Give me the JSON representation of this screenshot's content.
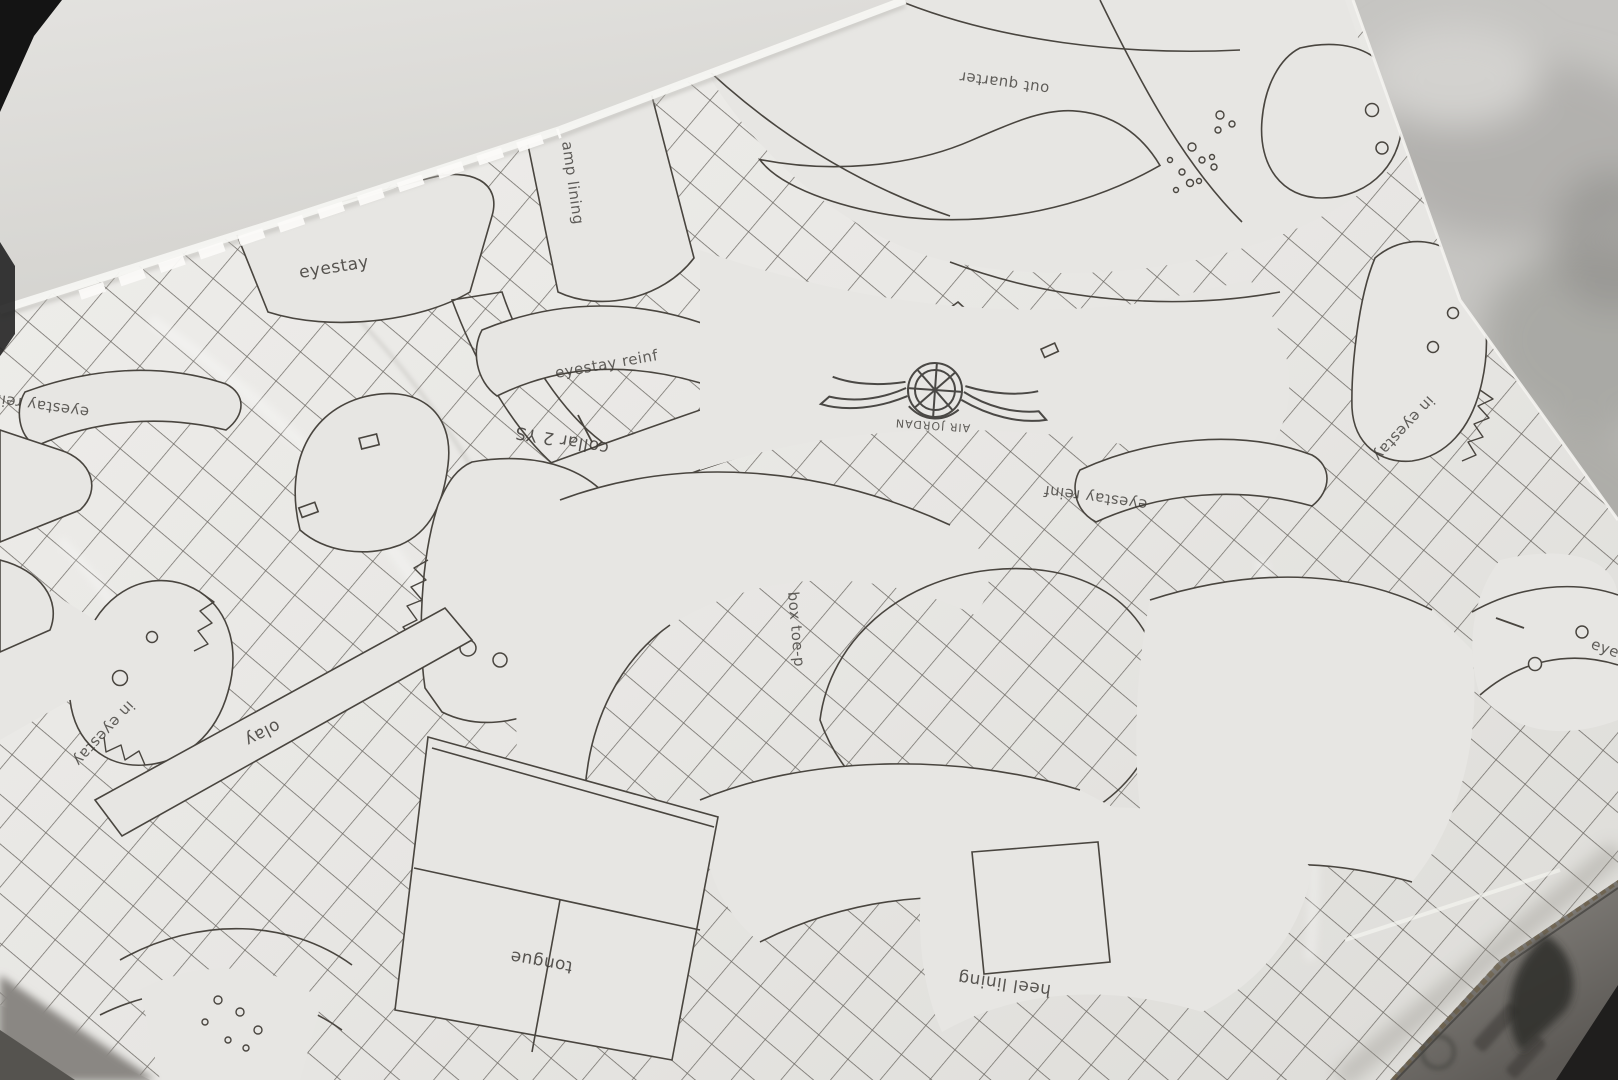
{
  "palette": {
    "paper": "#e7e6e3",
    "pattern_line": "#49453f",
    "hatch_line": "#56524c",
    "lid_interior": "#deddd9",
    "background_blur": "#c6c5c2",
    "shoebox_edge_gray": "#7d7a75",
    "corner_shadow_black": "#141414"
  },
  "paper_pattern": {
    "brand_logo_icon": "air-jordan-wings-logo",
    "logo_text": "AIR JORDAN",
    "labels": {
      "eyestay": "eyestay",
      "vamp_lining_partial": "amp lining",
      "eyestay_reinf_center": "eyestay reinf",
      "collar_2ys": "collar 2 YS",
      "out_quarter": "out quarter",
      "eyestay_reinf_left": "eyestay reinf",
      "eyestay_reinf_right": "eyestay reinf",
      "in_eyestay_left": "in eyestay",
      "in_eyestay_right": "in eyestay",
      "stay_strip": "olay",
      "box_toe": "box toe-p",
      "tongue": "tongue",
      "heel_lining": "heel lining",
      "eyestay_partial_right_edge": "eye"
    }
  }
}
